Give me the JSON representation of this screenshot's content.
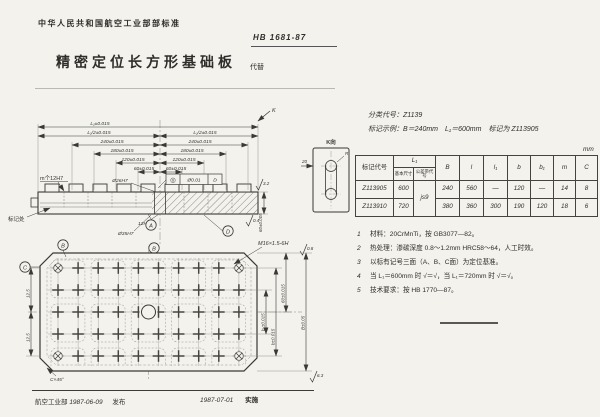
{
  "header": {
    "org": "中华人民共和国航空工业部部标准",
    "number": "HB 1681-87",
    "title": "精密定位长方形基础板",
    "replaces": "代替"
  },
  "info": {
    "class_line": "分类代号：Z1139",
    "example_line": "标记示例：B＝240mm　L₁＝600mm　标记为 Z113905",
    "unit": "mm"
  },
  "table": {
    "h": {
      "code": "标记代号",
      "L1": "L₁",
      "basic": "基本尺寸",
      "tol": "公差带代号",
      "B": "B",
      "l": "l",
      "l1": "l₁",
      "b": "b",
      "b1": "b₁",
      "m": "m",
      "C": "C"
    },
    "rows": [
      {
        "code": "Z113905",
        "L1": "600",
        "tol": "js9",
        "B": "240",
        "l": "560",
        "l1": "—",
        "b": "120",
        "b1": "—",
        "m": "14",
        "C": "8"
      },
      {
        "code": "Z113910",
        "L1": "720",
        "B": "380",
        "l": "360",
        "l1": "300",
        "b": "190",
        "b1": "120",
        "m": "18",
        "C": "6"
      }
    ]
  },
  "notes": [
    {
      "n": "1",
      "t": "材料：20CrMnTi，按 GB3077—82。"
    },
    {
      "n": "2",
      "t": "热处理：渗碳深度 0.8～1.2mm HRC58～64，人工时效。"
    },
    {
      "n": "3",
      "t": "以标有记号三面（A、B、C面）为定位基准。"
    },
    {
      "n": "4",
      "t": "当 L₁＝600mm 时 √＝√，当 L₁＝720mm 时 √＝√。"
    },
    {
      "n": "5",
      "t": "技术要求：按 HB 1770—87。"
    }
  ],
  "footer": {
    "issue_org": "航空工业部",
    "issue_date": "1987-06-09",
    "issue_label": "发布",
    "impl_date": "1987-07-01",
    "impl_label": "实施"
  },
  "drawing": {
    "side": {
      "m_holes": "m个12H7",
      "hole26": "Ø26H7",
      "hole12": "12H7",
      "hole35": "Ø35H7",
      "fcf_sym": "◎",
      "fcf_val": "Ø0.01",
      "fcf_ref": "D",
      "dim_L1": "L₁±0.015",
      "dim_half": "L₁/2±0.015",
      "d240": "240±0.015",
      "d180": "180±0.015",
      "d120": "120±0.015",
      "d60": "60±0.015",
      "mark": "标记处",
      "height": "60±0.005",
      "r32": "3.2",
      "r04": "0.4",
      "k_arrow": "K"
    },
    "kview": {
      "label": "K向",
      "r": "R",
      "d20": "20"
    },
    "plan": {
      "m16": "M16×1.5-6H",
      "r08": "0.8",
      "r63": "6.3",
      "chamfer": "C×45°",
      "d125": "12.5",
      "db1": "b₁±0.015",
      "db": "b±0.015",
      "d60": "60±0.015",
      "dB": "B±0.05"
    },
    "datums": {
      "a": "A",
      "b": "B",
      "c": "C",
      "d": "D"
    }
  }
}
